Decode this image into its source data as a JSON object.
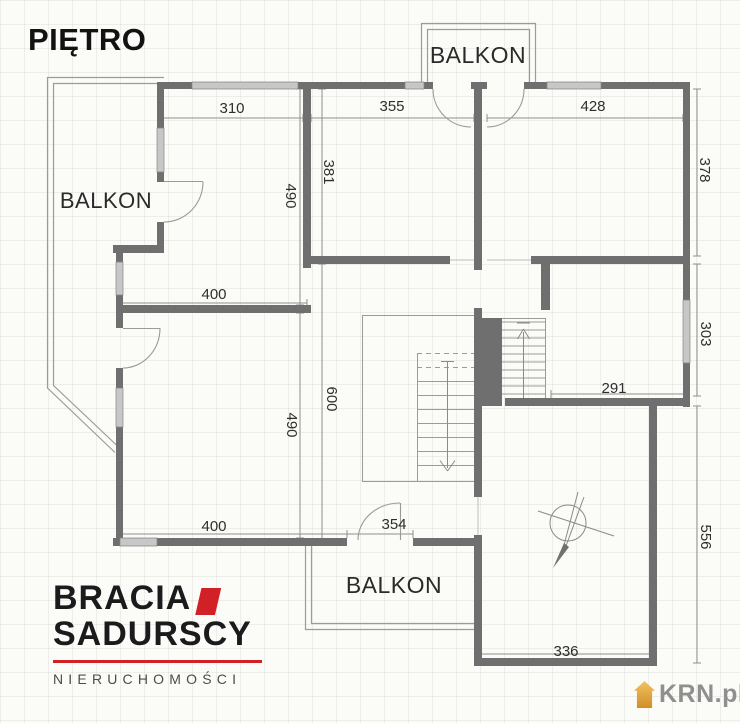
{
  "title": "PIĘTRO",
  "plan": {
    "balcony_top": "BALKON",
    "balcony_left": "BALKON",
    "balcony_bottom": "BALKON",
    "dims": {
      "t310": "310",
      "t355": "355",
      "t428": "428",
      "r378": "378",
      "r303": "303",
      "r556": "556",
      "v381": "381",
      "v490_top": "490",
      "v600": "600",
      "v490_bottom": "490",
      "w400_top": "400",
      "w400_bottom": "400",
      "door354": "354",
      "room291": "291",
      "b336": "336"
    }
  },
  "branding": {
    "agency_line1": "BRACIA",
    "agency_line2": "SADURSCY",
    "agency_line3": "NIERUCHOMOŚCI",
    "watermark_text": "KRN.pl"
  },
  "colors": {
    "wall_gray": "#6f6f6f",
    "logo_red": "#d22027",
    "krn_orange": "#e2a138"
  }
}
